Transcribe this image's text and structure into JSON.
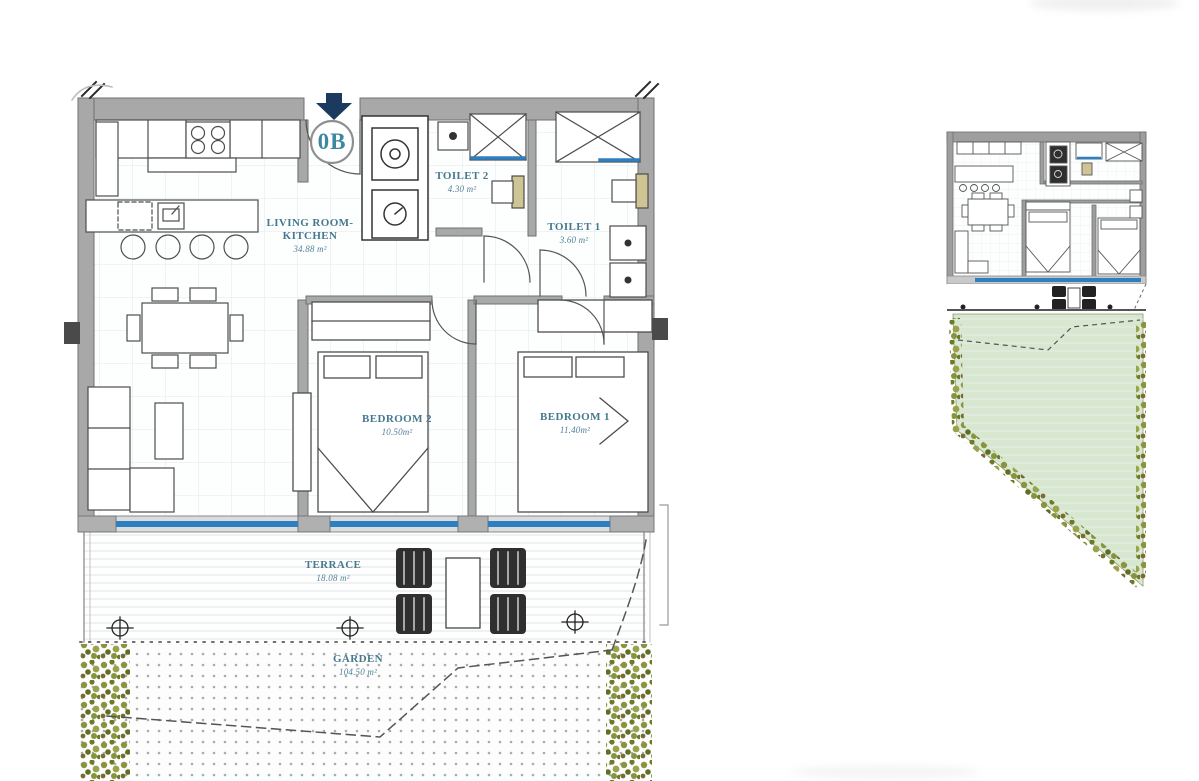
{
  "unit": {
    "label": "0B"
  },
  "rooms": {
    "living": {
      "line1": "LIVING ROOM-",
      "line2": "KITCHEN",
      "area": "34.88 m²"
    },
    "toilet2": {
      "name": "TOILET 2",
      "area": "4.30 m²"
    },
    "toilet1": {
      "name": "TOILET 1",
      "area": "3.60 m²"
    },
    "bedroom2": {
      "name": "BEDROOM 2",
      "area": "10.50m²"
    },
    "bedroom1": {
      "name": "BEDROOM 1",
      "area": "11.40m²"
    },
    "terrace": {
      "name": "TERRACE",
      "area": "18.08 m²"
    },
    "garden": {
      "name": "GARDEN",
      "area": "104.50 m²"
    }
  },
  "icons": {
    "entrance_arrow": "▼",
    "survey_marker": "⊕"
  },
  "colors": {
    "label_text": "#46798f",
    "unit_text": "#3d87a2",
    "glass_blue": "#2e7fc2",
    "wall_gray": "#a8a8a8",
    "arrow_navy": "#1c3a60",
    "garden_green": "#d8e7d0",
    "plant_olive": "#8a9440",
    "fixture_tan": "#cfc493"
  }
}
